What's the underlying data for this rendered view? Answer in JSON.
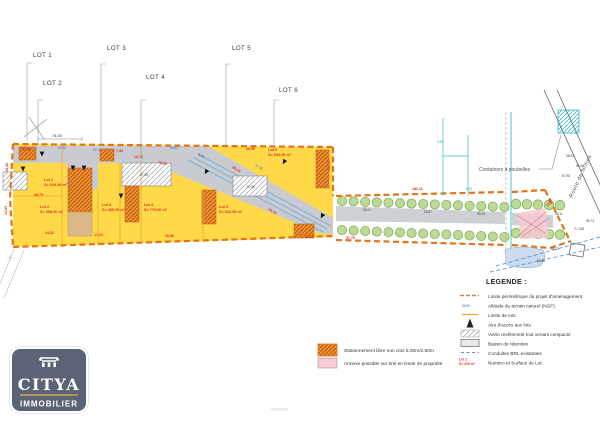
{
  "colors": {
    "lot_yellow": "#FFD947",
    "road_gray": "#C9CBD0",
    "perimeter_orange": "#E0751A",
    "lot_line_orange": "#F0A030",
    "parking_orange": "#ED9030",
    "dimension_red": "#E03020",
    "elevation_blue": "#3A6BC4",
    "survey_cyan": "#3BB8C4",
    "tree_green": "#BCDA96",
    "conduite_blue": "#4A90D9",
    "logo_background": "#5C6377",
    "logo_gold": "#C9A84C"
  },
  "plan": {
    "callouts": [
      {
        "label": "LOT 1",
        "tx": 33,
        "ty": 57,
        "lx": 27,
        "ly1": 63,
        "ly2": 141
      },
      {
        "label": "LOT 2",
        "tx": 43,
        "ty": 85,
        "lx": 38,
        "ly1": 100,
        "ly2": 145
      },
      {
        "label": "LOT 3",
        "tx": 107,
        "ty": 50,
        "lx": 101,
        "ly1": 64,
        "ly2": 146
      },
      {
        "label": "LOT 4",
        "tx": 146,
        "ty": 79,
        "lx": 141,
        "ly1": 100,
        "ly2": 158
      },
      {
        "label": "LOT 5",
        "tx": 232,
        "ty": 50,
        "lx": 226,
        "ly1": 64,
        "ly2": 147
      },
      {
        "label": "LOT 6",
        "tx": 279,
        "ty": 92,
        "lx": 274,
        "ly1": 100,
        "ly2": 150
      }
    ],
    "lots": [
      {
        "name": "Lot 1",
        "area": "S= 519,36 m²",
        "x": 44,
        "y": 181
      },
      {
        "name": "Lot 2",
        "area": "S= 268,00 m²",
        "x": 40,
        "y": 208
      },
      {
        "name": "Lot 3",
        "area": "S= 400,00 m²",
        "x": 102,
        "y": 206
      },
      {
        "name": "Lot 4",
        "area": "S= 770,00 m²",
        "x": 144,
        "y": 206
      },
      {
        "name": "Lot 5",
        "area": "S= 603,00 m²",
        "x": 268,
        "y": 151
      },
      {
        "name": "Lot 6",
        "area": "S= 622,00 m²",
        "x": 219,
        "y": 208
      }
    ],
    "dims": [
      {
        "t": "12,28",
        "x": 21,
        "y": 150
      },
      {
        "t": "14,32",
        "x": 8,
        "y": 172,
        "r": -90
      },
      {
        "t": "13,93",
        "x": 7,
        "y": 215,
        "r": -90
      },
      {
        "t": "48,75",
        "x": 34,
        "y": 196
      },
      {
        "t": "24,32",
        "x": 45,
        "y": 234
      },
      {
        "t": "17,23",
        "x": 94,
        "y": 236
      },
      {
        "t": "28,86",
        "x": 165,
        "y": 237
      },
      {
        "t": "41,11",
        "x": 305,
        "y": 238
      },
      {
        "t": "66,56",
        "x": 246,
        "y": 150
      },
      {
        "t": "86,19",
        "x": 232,
        "y": 168,
        "r": 30
      },
      {
        "t": "45,76",
        "x": 268,
        "y": 210,
        "r": 30
      },
      {
        "t": "7,30",
        "x": 116,
        "y": 152
      },
      {
        "t": "13,72",
        "x": 134,
        "y": 158
      },
      {
        "t": "16,93",
        "x": 158,
        "y": 163,
        "r": 15
      },
      {
        "t": "23,78",
        "x": 330,
        "y": 170,
        "r": -90
      },
      {
        "t": "182,11",
        "x": 412,
        "y": 190
      },
      {
        "t": "57,76",
        "x": 346,
        "y": 239
      },
      {
        "t": "15,87",
        "x": 548,
        "y": 207,
        "r": -62
      }
    ],
    "elevations": [
      {
        "t": "57.48",
        "x": 58,
        "y": 149,
        "c": "b"
      },
      {
        "t": "57.12",
        "x": 93,
        "y": 151,
        "c": "b"
      },
      {
        "t": "56.92",
        "x": 170,
        "y": 149,
        "c": "b"
      },
      {
        "t": "5,00",
        "x": 198,
        "y": 155,
        "c": "k",
        "r": 30
      },
      {
        "t": "57.35",
        "x": 255,
        "y": 166,
        "c": "b",
        "r": 30
      },
      {
        "t": "57,98",
        "x": 140,
        "y": 176,
        "c": "k"
      },
      {
        "t": "57,86",
        "x": 247,
        "y": 188,
        "c": "k"
      },
      {
        "t": "56.21",
        "x": 363,
        "y": 211,
        "c": "k"
      },
      {
        "t": "55.87",
        "x": 424,
        "y": 213,
        "c": "k"
      },
      {
        "t": "55.43",
        "x": 477,
        "y": 215,
        "c": "k"
      },
      {
        "t": "5,60",
        "x": 437,
        "y": 143,
        "c": "c"
      },
      {
        "t": "8,00",
        "x": 466,
        "y": 190,
        "c": "c"
      },
      {
        "t": "58.03",
        "x": 566,
        "y": 157,
        "c": "k"
      },
      {
        "t": "56.46",
        "x": 576,
        "y": 167,
        "c": "k"
      },
      {
        "t": "57.98",
        "x": 562,
        "y": 177,
        "c": "k"
      },
      {
        "t": "58.11",
        "x": 555,
        "y": 215,
        "c": "k"
      },
      {
        "t": "56.73",
        "x": 586,
        "y": 222,
        "c": "k"
      },
      {
        "t": "Y= 318",
        "x": 574,
        "y": 230,
        "c": "k"
      },
      {
        "t": "58.23",
        "x": 551,
        "y": 250,
        "c": "k"
      },
      {
        "t": "56.95",
        "x": 537,
        "y": 262,
        "c": "k"
      }
    ],
    "arrows": [
      {
        "x": 23,
        "y": 169
      },
      {
        "x": 42,
        "y": 154
      },
      {
        "x": 73,
        "y": 168
      },
      {
        "x": 84,
        "y": 168
      },
      {
        "x": 121,
        "y": 196
      },
      {
        "x": 206,
        "y": 172,
        "r": 30
      },
      {
        "x": 284,
        "y": 162,
        "r": 30
      },
      {
        "x": 322,
        "y": 216,
        "r": 30
      }
    ],
    "tree_rows": [
      {
        "x0": 342,
        "y0": 201,
        "dx": 11.6,
        "dy": 0.43,
        "n": 15,
        "r": 4.6
      },
      {
        "x0": 342,
        "y0": 230,
        "dx": 11.6,
        "dy": 0.5,
        "n": 15,
        "r": 4.6
      },
      {
        "x0": 516,
        "y0": 204,
        "dx": 11,
        "dy": 0.3,
        "n": 5,
        "r": 4.8
      },
      {
        "x0": 516,
        "y0": 233,
        "dx": 11,
        "dy": 0.4,
        "n": 5,
        "r": 4.8
      }
    ],
    "labels": {
      "dim_top": "74,00",
      "containers": "Containers à poubelles",
      "route": "Route de Nîmes"
    }
  },
  "legend": {
    "title": "LEGENDE :",
    "sample_ngf": "56.55",
    "sample_lot_line1": "Lot 1",
    "sample_lot_line2": "S= 200 m²",
    "items": [
      {
        "symbol": "orange-dashed-line",
        "label": "Limite périmétrique du projet d'aménagement"
      },
      {
        "symbol": "ngf-number",
        "label": "Altitude du terrain naturel (NGF)"
      },
      {
        "symbol": "orange-line",
        "label": "Limite de lots"
      },
      {
        "symbol": "black-arrow",
        "label": "Aire d'accès aux lots"
      },
      {
        "symbol": "gray-hatch-box",
        "label": "Voirie revêtement tout venant compacté"
      },
      {
        "symbol": "basin-box",
        "label": "Bassin de rétention"
      },
      {
        "symbol": "blue-dashed-line",
        "label": "Conduites BRL existantes"
      },
      {
        "symbol": "red-lot-text",
        "label": "Numéro et Surface de Lot"
      }
    ]
  },
  "notes": [
    {
      "symbol": "orange-hatch-box",
      "label": "Stationnement libre non clos  5.00m/2.50m"
    },
    {
      "symbol": "pink-box",
      "label": "Annexe possible sur 6ml en limite de propriété"
    }
  ],
  "logo": {
    "brand": "CITYA",
    "subtitle": "IMMOBILIER"
  }
}
